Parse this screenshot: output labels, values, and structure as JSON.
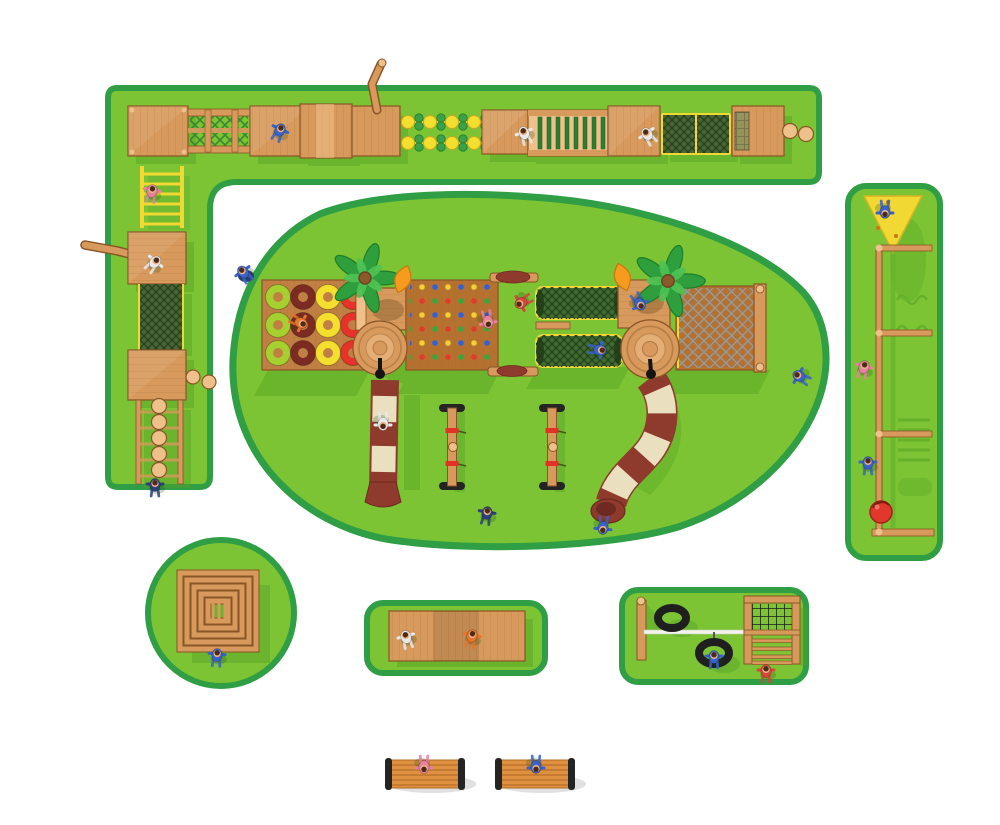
{
  "title": "Wooden adventure playground - top view site plan",
  "palette": {
    "background": "#ffffff",
    "grass": "#7cc433",
    "grass-border": "#2f9e44",
    "grass-shadow": "#55a128",
    "wood": "#d79a5c",
    "wood-light": "#eec08a",
    "wood-dark": "#a0662c",
    "deck": "#c08043",
    "deck-dark": "#b5712f",
    "rope-yellow": "#f2d832",
    "mesh-green": "#4a6436",
    "mesh-line": "#243f1c",
    "lattice-green": "#2e7d32",
    "slide-maroon": "#8e3a2d",
    "slide-maroon-dark": "#6e2a20",
    "slide-cream": "#eadfbe",
    "canopy-orange": "#f59b1e",
    "palm-green": "#2f9e3c",
    "palm-green-light": "#4ec455",
    "trunk-brown": "#8a5a2b",
    "ring-green": "#a6d02f",
    "ring-maroon": "#7c2b22",
    "ring-yellow": "#f4df2e",
    "ring-red": "#e63228",
    "tire-black": "#1f1f1f",
    "ball-red": "#e0392b",
    "rope-gray": "#949a9e",
    "white-beam": "#f4f4ec",
    "bench-wood": "#e0913f",
    "bench-dark": "#242424",
    "skin": "#eab188",
    "hair": "#4a2c18",
    "kid-blue": "#3a62c8",
    "kid-navy": "#2c3f7a",
    "kid-pink": "#e87fa0",
    "kid-white": "#e9e9e9",
    "kid-orange": "#e8732a",
    "kid-red": "#d8453a",
    "hold-red": "#e33a2c",
    "hold-blue": "#2f62d8",
    "hold-yellow": "#f2d12e",
    "hold-green": "#39a83c"
  },
  "zones": [
    {
      "id": "obstacle-course-l",
      "label": "L-shaped wooden obstacle course strip"
    },
    {
      "id": "main-play-island",
      "label": "Main play island with two towers and slides"
    },
    {
      "id": "climb-strip",
      "label": "Vertical climbing frame strip"
    },
    {
      "id": "log-pyramid-circle",
      "label": "Log pyramid circle"
    },
    {
      "id": "deck-pad",
      "label": "Wooden deck pad"
    },
    {
      "id": "tire-swing-pad",
      "label": "Tire swing and climber pad"
    },
    {
      "id": "benches",
      "label": "Park benches"
    }
  ],
  "equipment": {
    "obstacle_course": [
      "platform deck",
      "rail bridge with lattice",
      "plank arch bridge",
      "periscope pole",
      "stepping discs",
      "ramp deck",
      "green rung bridge",
      "chain-link net crawl",
      "mesh deck",
      "wooden balls",
      "yellow access ladder",
      "bent log beam",
      "cargo net climb",
      "stepping ball walk"
    ],
    "main_play_island": [
      "tire ring walk",
      "palm tree",
      "orange leaf canopy",
      "round tower",
      "straight slide",
      "rock climbing wall",
      "log bar with dome cap",
      "net crawl tunnel",
      "steps deck",
      "curved tube slide",
      "rope net bridge",
      "seesaw"
    ],
    "climb_strip": [
      "yellow triangle climber",
      "climbing pole with crossbars",
      "red ball"
    ],
    "tire_swing_pad": [
      "post",
      "white beam",
      "tire",
      "tire swing",
      "net and rung climber"
    ],
    "counts": {
      "ring_rows": 3,
      "ring_cols": 4,
      "stepping_balls": 5,
      "net_tunnels": 2,
      "seesaws": 2,
      "benches": 2,
      "palm_trees": 2,
      "towers": 2,
      "slides": 2,
      "tires": 2,
      "crossbars": 4
    },
    "ring_column_colors": [
      "green",
      "maroon",
      "yellow",
      "red"
    ]
  },
  "figures": {
    "children_total": 26,
    "outfit_colors": [
      "blue",
      "navy",
      "pink",
      "white",
      "orange",
      "red"
    ]
  }
}
